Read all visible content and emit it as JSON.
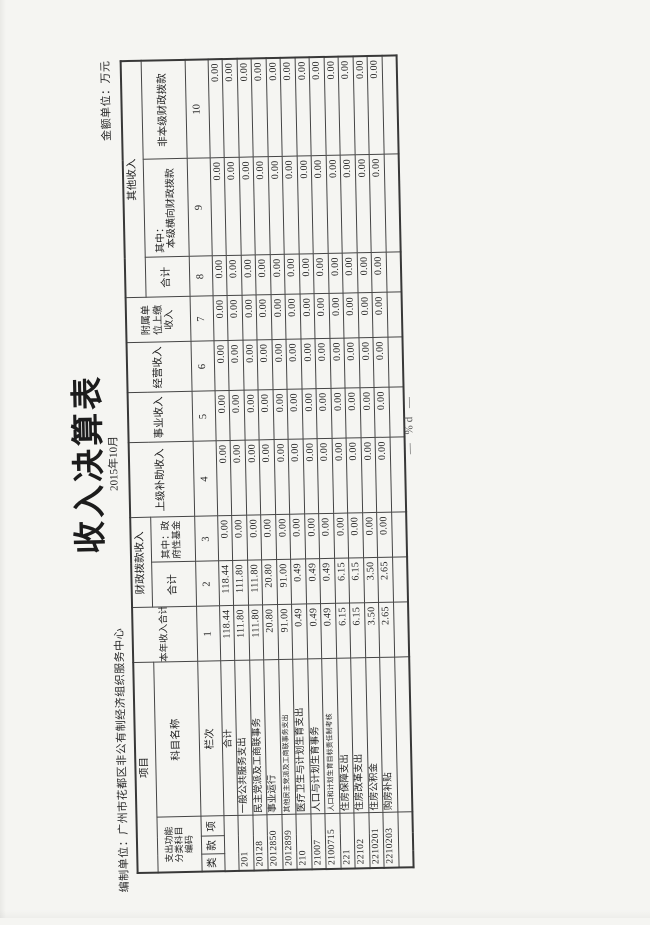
{
  "page": {
    "title": "收入决算表",
    "subtitle": "2015年10月",
    "prepared_by": "编制单位：广州市花都区非公有制经济组织服务中心",
    "unit_label": "金额单位：万元",
    "footer": "— %d —"
  },
  "table": {
    "header": {
      "item": "项目",
      "code_group": "支出功能分类科目编码",
      "code_cols": [
        "类",
        "款",
        "项"
      ],
      "subject_name": "科目名称",
      "row_index_label": "栏次",
      "total_income": "本年收入合计",
      "fiscal_grant_group": "财政拨款收入",
      "fiscal_total": "合计",
      "fiscal_gov_fund": "其中：政府性基金",
      "higher_subsidy": "上级补助收入",
      "operation_income": "事业收入",
      "business_income": "经营收入",
      "affiliate_income": "附属单位上缴收入",
      "other_income_group": "其他收入",
      "other_total": "合计",
      "other_among_label": "其中：",
      "other_horizontal": "本级横向财政拨款",
      "other_nonlocal": "非本级财政拨款",
      "column_numbers": [
        "1",
        "2",
        "3",
        "4",
        "5",
        "6",
        "7",
        "8",
        "9",
        "10"
      ]
    },
    "rows": [
      {
        "code": "",
        "name": "合计",
        "values": [
          "118.44",
          "118.44",
          "0.00",
          "0.00",
          "0.00",
          "0.00",
          "0.00",
          "0.00",
          "0.00",
          "0.00"
        ]
      },
      {
        "code": "201",
        "name": "一般公共服务支出",
        "values": [
          "111.80",
          "111.80",
          "0.00",
          "0.00",
          "0.00",
          "0.00",
          "0.00",
          "0.00",
          "0.00",
          "0.00"
        ]
      },
      {
        "code": "20128",
        "name": "民主党派及工商联事务",
        "values": [
          "111.80",
          "111.80",
          "0.00",
          "0.00",
          "0.00",
          "0.00",
          "0.00",
          "0.00",
          "0.00",
          "0.00"
        ]
      },
      {
        "code": "2012850",
        "name": "事业运行",
        "values": [
          "20.80",
          "20.80",
          "0.00",
          "0.00",
          "0.00",
          "0.00",
          "0.00",
          "0.00",
          "0.00",
          "0.00"
        ]
      },
      {
        "code": "2012899",
        "name": "其他民主党派及工商联事务支出",
        "values": [
          "91.00",
          "91.00",
          "0.00",
          "0.00",
          "0.00",
          "0.00",
          "0.00",
          "0.00",
          "0.00",
          "0.00"
        ]
      },
      {
        "code": "210",
        "name": "医疗卫生与计划生育支出",
        "values": [
          "0.49",
          "0.49",
          "0.00",
          "0.00",
          "0.00",
          "0.00",
          "0.00",
          "0.00",
          "0.00",
          "0.00"
        ]
      },
      {
        "code": "21007",
        "name": "人口与计划生育事务",
        "values": [
          "0.49",
          "0.49",
          "0.00",
          "0.00",
          "0.00",
          "0.00",
          "0.00",
          "0.00",
          "0.00",
          "0.00"
        ]
      },
      {
        "code": "2100715",
        "name": "人口和计划生育目标责任制考核",
        "values": [
          "0.49",
          "0.49",
          "0.00",
          "0.00",
          "0.00",
          "0.00",
          "0.00",
          "0.00",
          "0.00",
          "0.00"
        ]
      },
      {
        "code": "221",
        "name": "住房保障支出",
        "values": [
          "6.15",
          "6.15",
          "0.00",
          "0.00",
          "0.00",
          "0.00",
          "0.00",
          "0.00",
          "0.00",
          "0.00"
        ]
      },
      {
        "code": "22102",
        "name": "住房改革支出",
        "values": [
          "6.15",
          "6.15",
          "0.00",
          "0.00",
          "0.00",
          "0.00",
          "0.00",
          "0.00",
          "0.00",
          "0.00"
        ]
      },
      {
        "code": "2210201",
        "name": "住房公积金",
        "values": [
          "3.50",
          "3.50",
          "0.00",
          "0.00",
          "0.00",
          "0.00",
          "0.00",
          "0.00",
          "0.00",
          "0.00"
        ]
      },
      {
        "code": "2210203",
        "name": "购房补贴",
        "values": [
          "2.65",
          "2.65",
          "0.00",
          "0.00",
          "0.00",
          "0.00",
          "0.00",
          "0.00",
          "0.00",
          "0.00"
        ]
      },
      {
        "code": "",
        "name": "",
        "values": [
          "",
          "",
          "",
          "",
          "",
          "",
          "",
          "",
          "",
          ""
        ]
      }
    ]
  }
}
